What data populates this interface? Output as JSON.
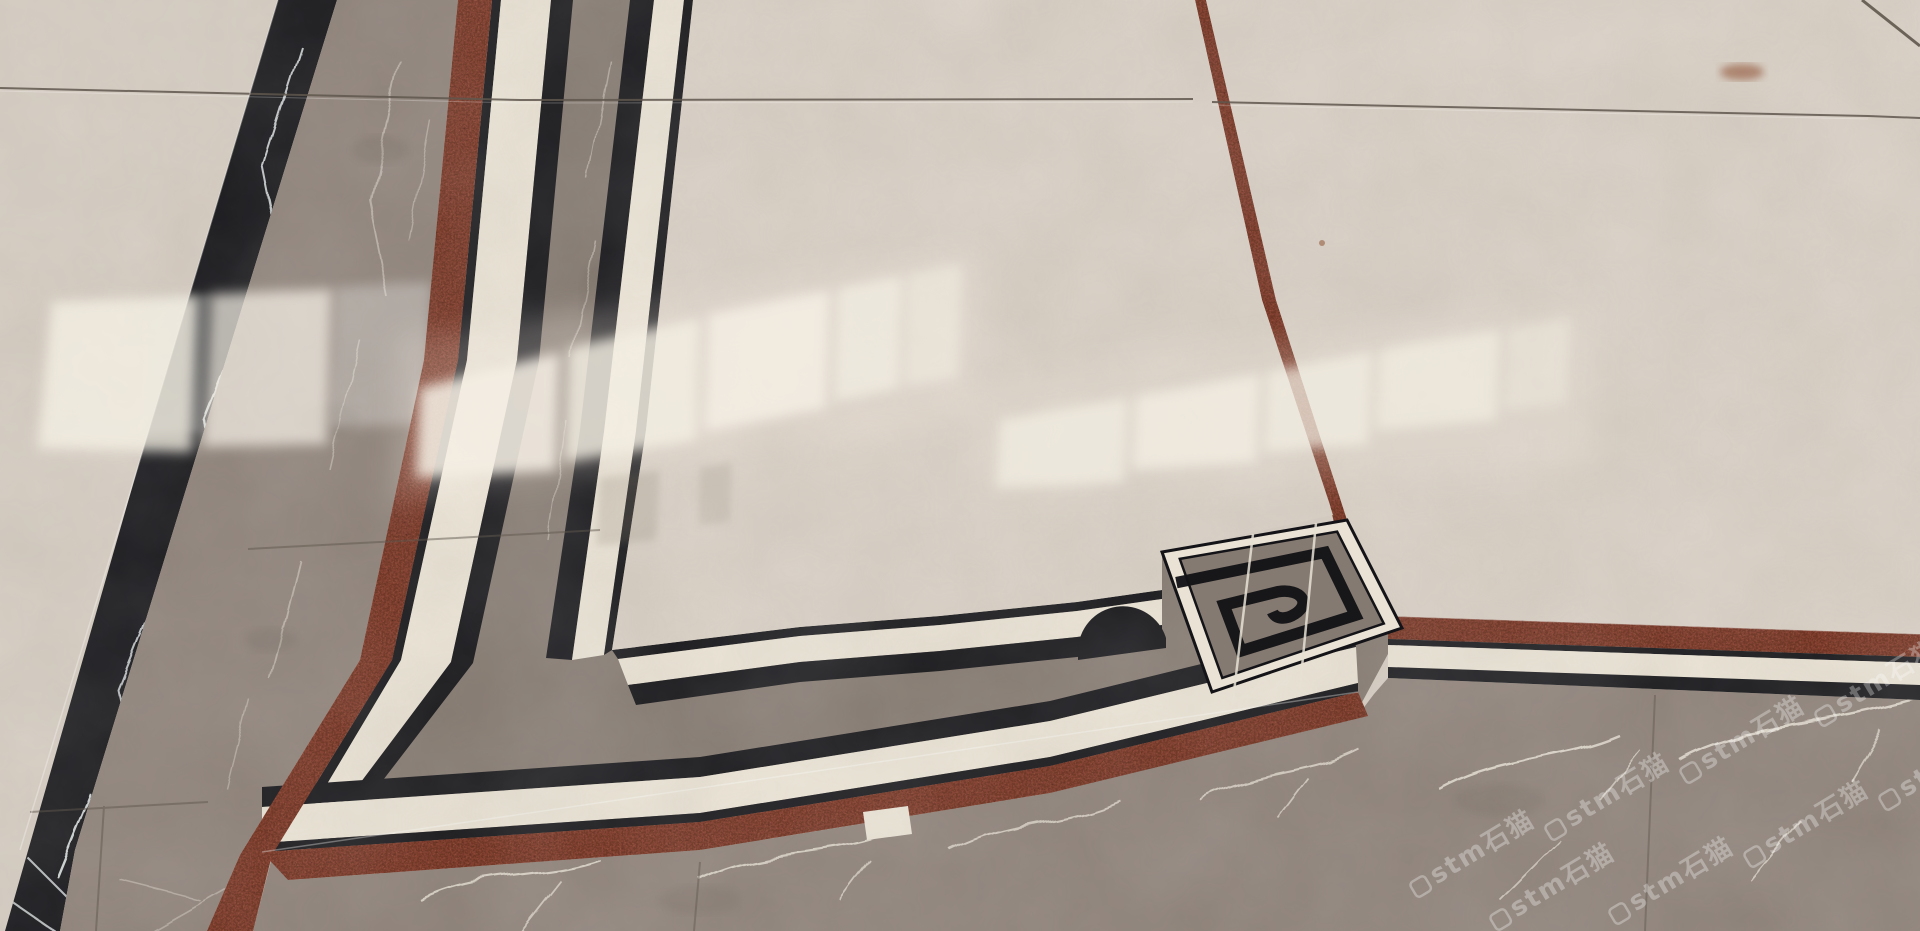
{
  "image": {
    "title": "Polished marble floor with decorative inlay border",
    "description": "Photograph of a marble tile dry-lay: beige marble fields framed by black keylines, a grey marble border band, red coil-mat strips, and a Greek-key corner motif. Bright window reflections streak across the polished surface."
  },
  "watermark": {
    "text": "stm石猫",
    "logo": "rounded-square-logo-icon",
    "color": "rgba(255,255,255,0.30)",
    "angle_deg": -31,
    "instances": 8
  },
  "materials": [
    {
      "name": "beige-marble-field",
      "color": "#d6cdc2"
    },
    {
      "name": "beige-marble-bright",
      "color": "#efe9dd"
    },
    {
      "name": "white-marble-keyline-band",
      "color": "#eae3d5"
    },
    {
      "name": "black-marquina-marble",
      "color": "#141418"
    },
    {
      "name": "grey-marble-band",
      "color": "#8d8178"
    },
    {
      "name": "grey-marble-dark",
      "color": "#6e645c"
    },
    {
      "name": "red-coil-mat-strip",
      "color": "#7c3323"
    },
    {
      "name": "grout-joint",
      "color": "#5f574d"
    },
    {
      "name": "rust-stain",
      "color": "#8a4a2a"
    }
  ],
  "colors": {
    "cream_field": "#d6cdc2",
    "cream_field2": "#d9d0c5",
    "cream_bright": "#efe9dd",
    "keyline_cream": "#eae3d5",
    "black_marble": "#141418",
    "grey_marble": "#8d8178",
    "grey_marble2": "#857a71",
    "grey_dark": "#6e645c",
    "grey_vein": "#e8e2d6",
    "red_strip": "#7c3323",
    "red_dark": "#3f120b",
    "red_light": "#b2684a",
    "grout": "#5f574d",
    "watermark": "rgba(255,255,255,0.30)",
    "rust": "#8a4a2a"
  },
  "features": {
    "greek_key_motif": "square Greek-key spiral inlay, black on grey marble with cream border",
    "dome_accent": "black half-round accent on inner keyline",
    "reflections": "window/light reflections on polished floor",
    "joints": "tile grout joints crossing the layout"
  }
}
